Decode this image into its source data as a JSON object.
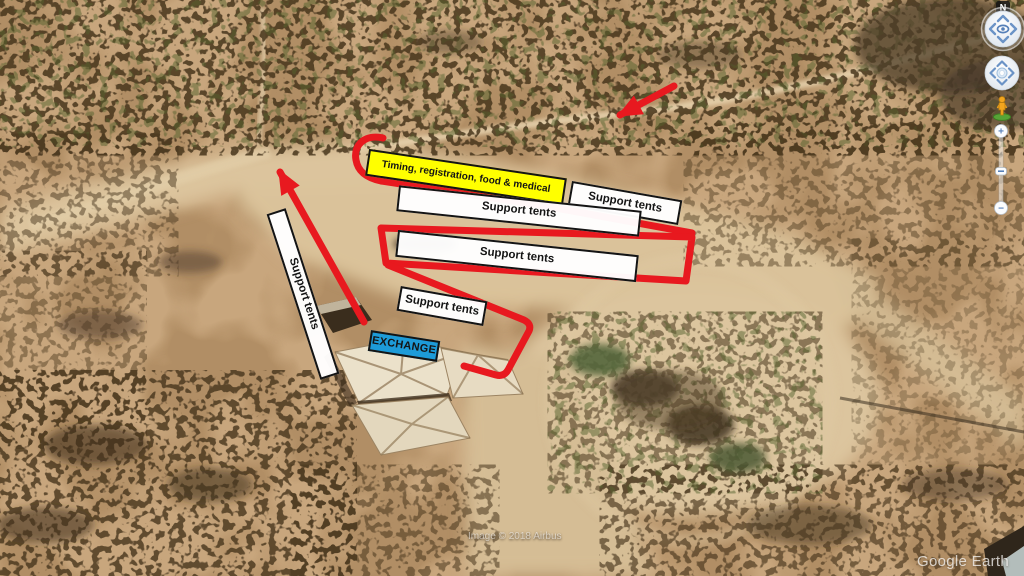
{
  "map": {
    "attribution": "Image © 2018 Airbus",
    "watermark": "Google Earth"
  },
  "overlay": {
    "accent_red": "#e8191f",
    "timing_box": {
      "label": "Timing, registration, food & medical",
      "fill": "#ffff00"
    },
    "exchange_box": {
      "label": "EXCHANGE",
      "fill": "#1d9bd8"
    },
    "support_bars": [
      {
        "label": "Support tents"
      },
      {
        "label": "Support tents"
      },
      {
        "label": "Support tents"
      },
      {
        "label": "Support tents"
      },
      {
        "label": "Support tents"
      }
    ]
  },
  "earth_nav": {
    "north_label": "N",
    "zoom_in_label": "+",
    "zoom_out_label": "−"
  }
}
